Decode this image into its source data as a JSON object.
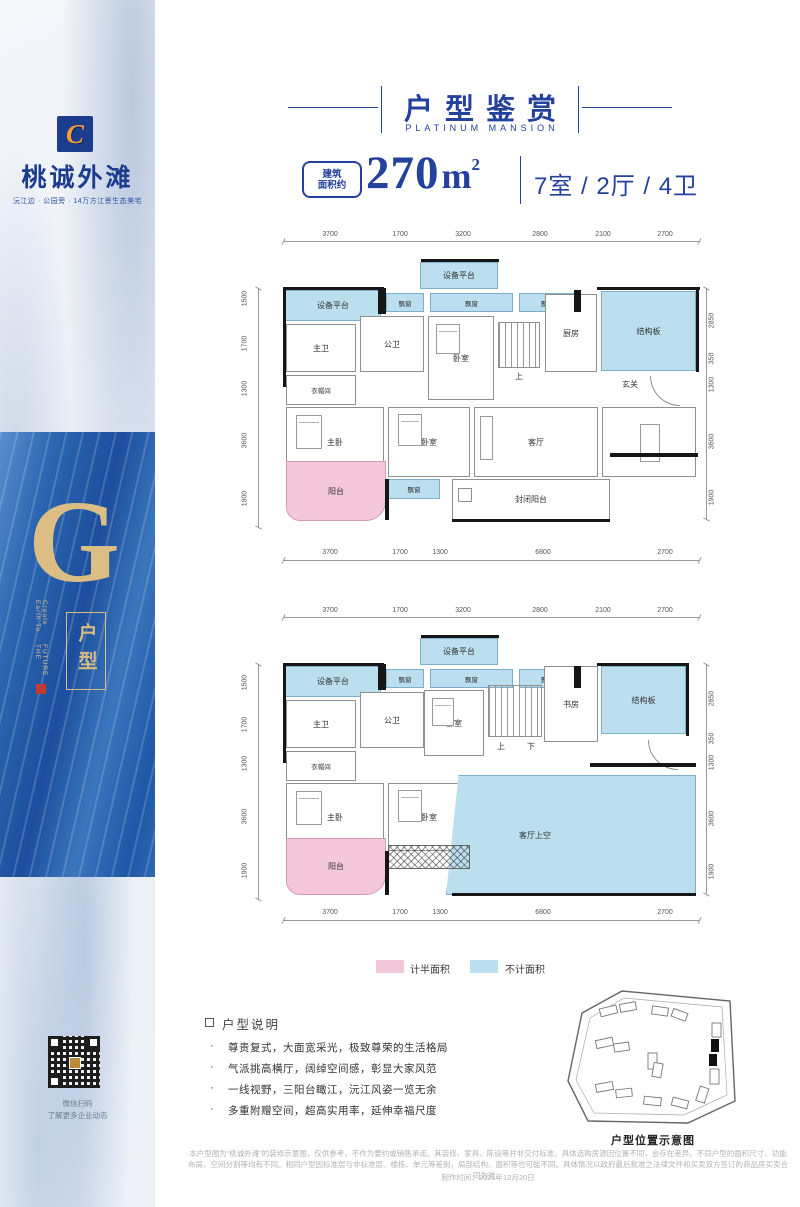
{
  "sidebar": {
    "logo_letter": "C",
    "brand": "桃诚外滩",
    "tagline": "沅江边 · 公园旁 · 14万方江景生态美宅",
    "g_letter": "G",
    "vertical_en_1": "Earth To Create",
    "vertical_en_2": "THE FUTURE",
    "type_label": "户型",
    "qr_caption_1": "微信扫码",
    "qr_caption_2": "了解更多企业动态"
  },
  "header": {
    "title": "户型鉴赏",
    "subtitle": "PLATINUM MANSION"
  },
  "spec": {
    "badge_line1": "建筑",
    "badge_line2": "面积约",
    "area": "270",
    "unit": "m",
    "unit_sup": "2",
    "layout": "7室 / 2厅 / 4卫"
  },
  "plan_upper": {
    "dims_top": [
      "3700",
      "1700",
      "3200",
      "2800",
      "2100",
      "2700"
    ],
    "dims_bottom": [
      "3700",
      "1700",
      "1300",
      "6800",
      "2700"
    ],
    "dims_left": [
      "1500",
      "1700",
      "1300",
      "3600",
      "1900"
    ],
    "dims_right": [
      "2850",
      "350",
      "1300",
      "3600",
      "1900"
    ],
    "rooms": {
      "dev_mid": "设备平台",
      "dev_left": "设备平台",
      "bay1": "飘窗",
      "bay2": "飘窗",
      "bay3": "飘窗",
      "kitchen": "厨房",
      "struct": "结构板",
      "master_bath": "主卫",
      "pub_bath": "公卫",
      "bedroom_top": "卧室",
      "stairs_up": "上",
      "cloak": "衣帽间",
      "foyer": "玄关",
      "master_bed": "主卧",
      "bedroom2": "卧室",
      "living": "客厅",
      "dining": "餐厅",
      "balcony": "阳台",
      "bay_bottom": "飘窗",
      "enclosed": "封闭阳台"
    }
  },
  "plan_lower": {
    "dims_top": [
      "3700",
      "1700",
      "3200",
      "2800",
      "2100",
      "2700"
    ],
    "dims_bottom": [
      "3700",
      "1700",
      "1300",
      "6800",
      "2700"
    ],
    "dims_left": [
      "1500",
      "1700",
      "1300",
      "3600",
      "1900"
    ],
    "dims_right": [
      "2850",
      "350",
      "1300",
      "3600",
      "1900"
    ],
    "rooms": {
      "dev_mid": "设备平台",
      "dev_left": "设备平台",
      "bay1": "飘窗",
      "bay2": "飘窗",
      "bay3": "飘窗",
      "study": "书房",
      "struct": "结构板",
      "master_bath": "主卫",
      "pub_bath": "公卫",
      "bedroom_top": "卧室",
      "stairs_up": "上",
      "stairs_down": "下",
      "cloak": "衣帽间",
      "master_bed": "主卧",
      "bedroom2": "卧室",
      "void": "客厅上空",
      "balcony": "阳台"
    }
  },
  "legend": {
    "half_label": "计半面积",
    "half_color": "#f4c7da",
    "excluded_label": "不计面积",
    "excluded_color": "#bcdff0"
  },
  "notes": {
    "heading": "户型说明",
    "bullet_char": "·",
    "bullets": [
      "尊贵复式，大面宽采光，极致尊荣的生活格局",
      "气派挑高横厅，阔绰空间感，彰显大家风范",
      "一线视野，三阳台瞰江，沅江风姿一览无余",
      "多重附赠空间，超高实用率，延伸幸福尺度"
    ]
  },
  "siteplan": {
    "caption": "户型位置示意图"
  },
  "footer": {
    "disclaimer": "本户型图为“桃诚外滩”的装修示意图，仅供参考，不作为要约或销售承诺。其装修、家具、陈设等并非交付标准。具体选购房源因位置不同，会存在差异。不同户型的面积尺寸、功能布局、空间分割等均有不同。相同户型因标准层与非标准层、楼栋、单元等差别，局部结构、面积等也可能不同。具体情况以政府最后批准之法律文件和买卖双方签订的商品房买卖合同为准。",
    "produced": "制作时间：2021年12月20日"
  }
}
